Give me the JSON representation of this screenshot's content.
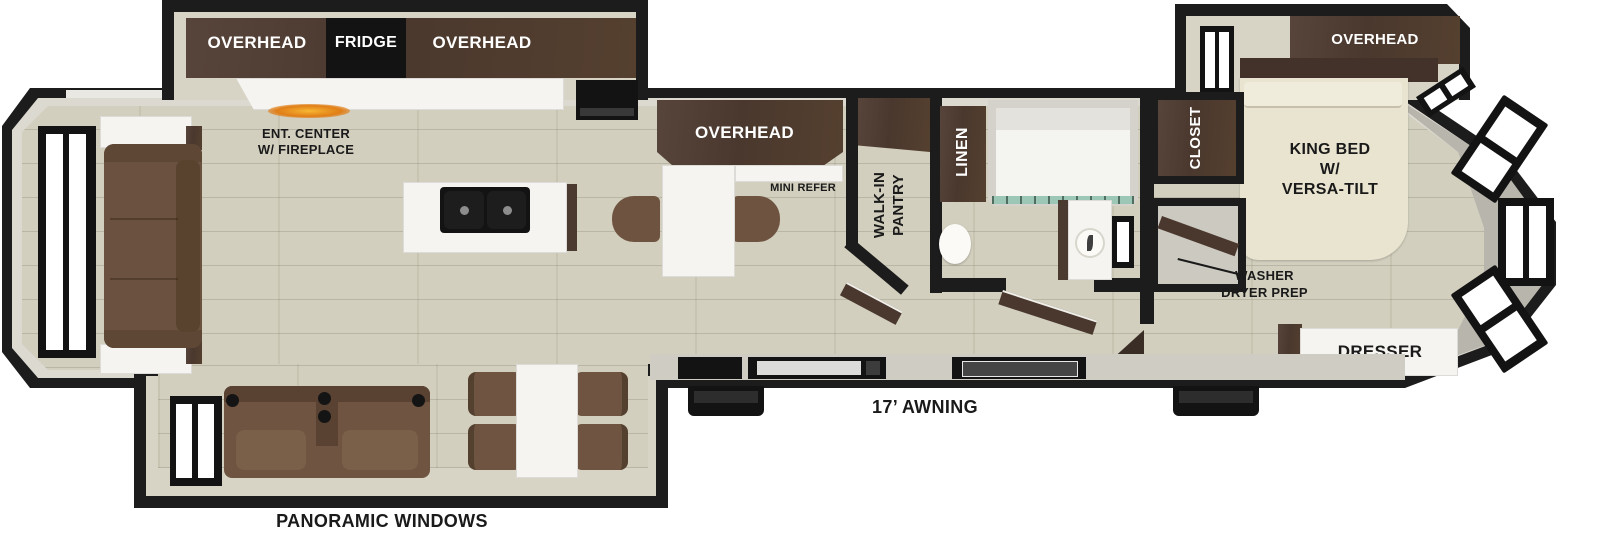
{
  "diagram": {
    "type": "RV fifth-wheel floorplan",
    "colors": {
      "wall": "#1c1c1c",
      "wall_lining": "#dcd9d0",
      "floor": "#d2cfbe",
      "cabinet_wood": "#4e3c32",
      "appliance_black": "#131313",
      "counter_white": "#f5f4f1",
      "upholstery_brown": "#6e5441",
      "bed_cream": "#e8e4d0",
      "fireplace_orange": "#e07e17",
      "shower_glass_teal": "#9cc7b6",
      "label_dark": "#1a1a1a",
      "label_light": "#ffffff"
    },
    "labels": {
      "kitchen_overhead_left": "OVERHEAD",
      "fridge": "FRIDGE",
      "kitchen_overhead_right": "OVERHEAD",
      "ent_center": "ENT. CENTER\nW/ FIREPLACE",
      "peninsula_overhead": "OVERHEAD",
      "mini_refer": "MINI REFER",
      "walk_in_pantry": "WALK-IN\nPANTRY",
      "linen": "LINEN",
      "closet": "CLOSET",
      "bedroom_overhead": "OVERHEAD",
      "king_bed": "KING BED\nW/\nVERSA-TILT",
      "washer_dryer_prep": "WASHER\nDRYER PREP",
      "dresser": "DRESSER",
      "awning": "17’ AWNING",
      "panoramic_windows": "PANORAMIC WINDOWS"
    }
  }
}
